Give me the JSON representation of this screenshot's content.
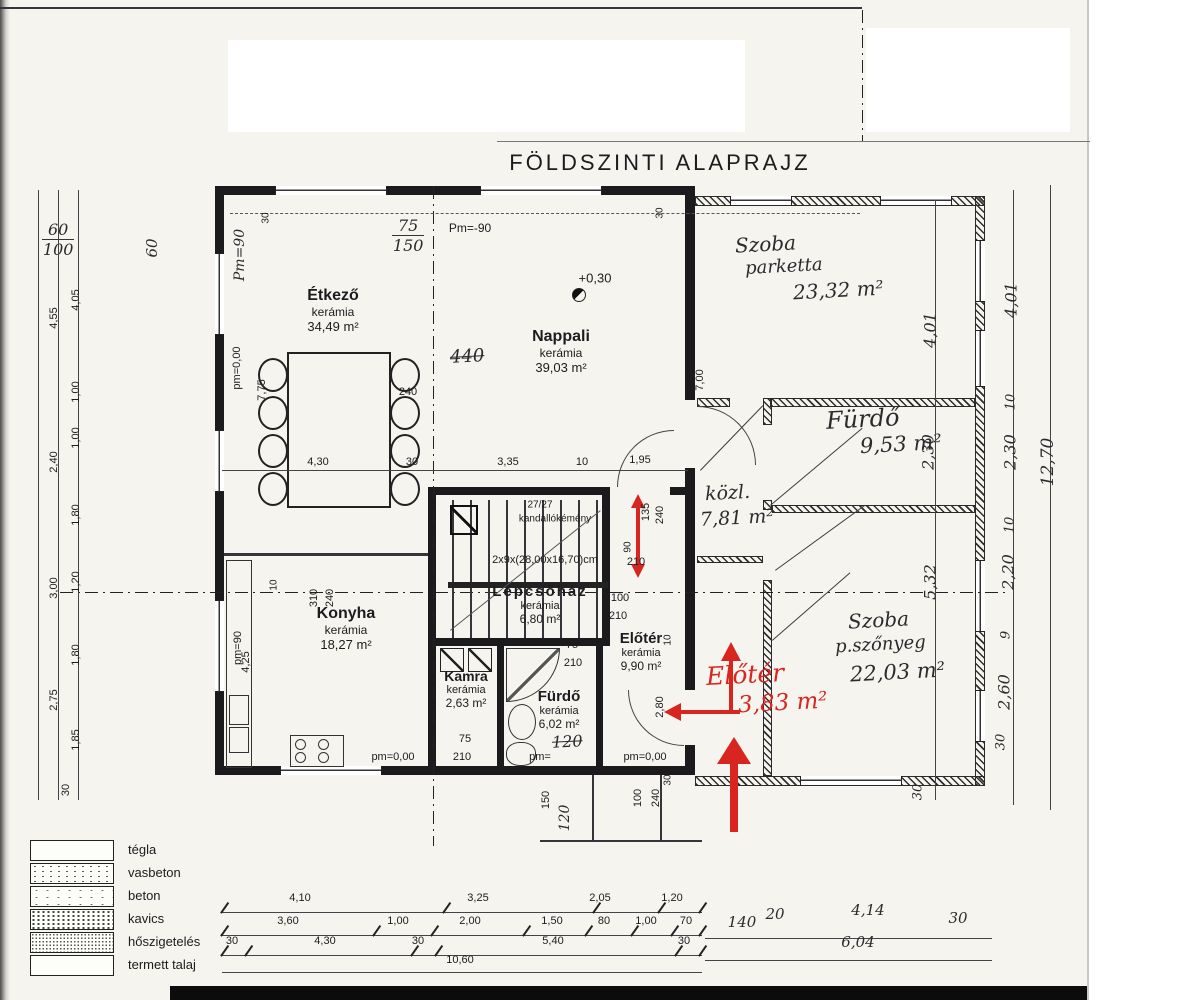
{
  "title": "FÖLDSZINTI ALAPRAJZ",
  "colors": {
    "red": "#d8251f",
    "ink": "#1c1c1e",
    "paper": "#f5f4ef"
  },
  "rooms": {
    "etkezo": {
      "name": "Étkező",
      "finish": "kerámia",
      "area": "34,49 m²"
    },
    "nappali": {
      "name": "Nappali",
      "finish": "kerámia",
      "area": "39,03 m²"
    },
    "konyha": {
      "name": "Konyha",
      "finish": "kerámia",
      "area": "18,27 m²"
    },
    "kamra": {
      "name": "Kamra",
      "finish": "kerámia",
      "area": "2,63 m²"
    },
    "furdo": {
      "name": "Fürdő",
      "finish": "kerámia",
      "area": "6,02 m²"
    },
    "eloter": {
      "name": "Előtér",
      "finish": "kerámia",
      "area": "9,90 m²"
    },
    "lepcsohaz": {
      "name": "Lépcsőház",
      "finish": "kerámia",
      "area": "6,80 m²"
    }
  },
  "handwritten": {
    "szoba1": {
      "name": "Szoba",
      "finish": "parketta",
      "area": "23,32 m²"
    },
    "furdo2": {
      "name": "Fürdő",
      "area": "9,53 m²"
    },
    "kozl": {
      "name": "közl.",
      "area": "7,81 m²"
    },
    "szoba2": {
      "name": "Szoba",
      "finish": "p.szőnyeg",
      "area": "22,03 m²"
    },
    "eloter_red": {
      "name": "Előtér",
      "area": "3,83 m²"
    },
    "n440": "440",
    "n120": "120",
    "frac_top1": "60",
    "frac_bot1": "100",
    "frac_top2": "75",
    "frac_bot2": "150",
    "pm90": "Pm=90",
    "r60": "60"
  },
  "notes": {
    "stairs": "2x9x(28,00x16,70)cm",
    "chimney_size": "27/27",
    "chimney": "kandallókémény",
    "level": "+0,30",
    "pm000": "pm=0,00",
    "pm_eq": "pm=",
    "pm90neg": "Pm=-90",
    "pm90": "pm=90"
  },
  "legend": [
    "tégla",
    "vasbeton",
    "beton",
    "kavics",
    "hőszigetelés",
    "termett talaj"
  ],
  "dims": {
    "bottom1": [
      "4,10",
      "3,25",
      "2,05",
      "1,20"
    ],
    "bottom2": [
      "3,60",
      "1,00",
      "2,00",
      "1,50",
      "80",
      "1,00",
      "70"
    ],
    "bottom3": [
      "30",
      "4,30",
      "30",
      "5,40",
      "30"
    ],
    "total_bottom": "10,60",
    "bottom_right": [
      "140",
      "20",
      "4,14",
      "30"
    ],
    "total_bottom_right": "6,04",
    "mid": [
      "4,30",
      "30",
      "3,35",
      "10",
      "1,95"
    ],
    "left_inner": [
      "4,05",
      "1,00",
      "1,00",
      "1,80",
      "1,20",
      "1,80",
      "1,85",
      "30"
    ],
    "left_outer": [
      "4,55",
      "2,40",
      "3,00",
      "2,75"
    ],
    "right_inner": [
      "4,01",
      "2,30",
      "5,32",
      "30"
    ],
    "right_outer": [
      "4,01",
      "10",
      "2,30",
      "10",
      "2,20",
      "9",
      "2,60",
      "30"
    ],
    "right_total": "12,70",
    "v775": "7,75",
    "v700": "7,00",
    "v425": "4,25",
    "v310": "310",
    "v240": "240",
    "v10": "10",
    "h240": "240",
    "d135": "135",
    "d240": "240",
    "d90": "90",
    "d210": "210",
    "d100": "100",
    "d210b": "210",
    "d75": "75",
    "d210c": "210",
    "d75k": "75",
    "d210k": "210",
    "d280": "2,80",
    "d10": "10",
    "p150": "150",
    "p100": "100",
    "p240": "240",
    "p30": "30",
    "t30a": "30",
    "t30b": "30"
  }
}
